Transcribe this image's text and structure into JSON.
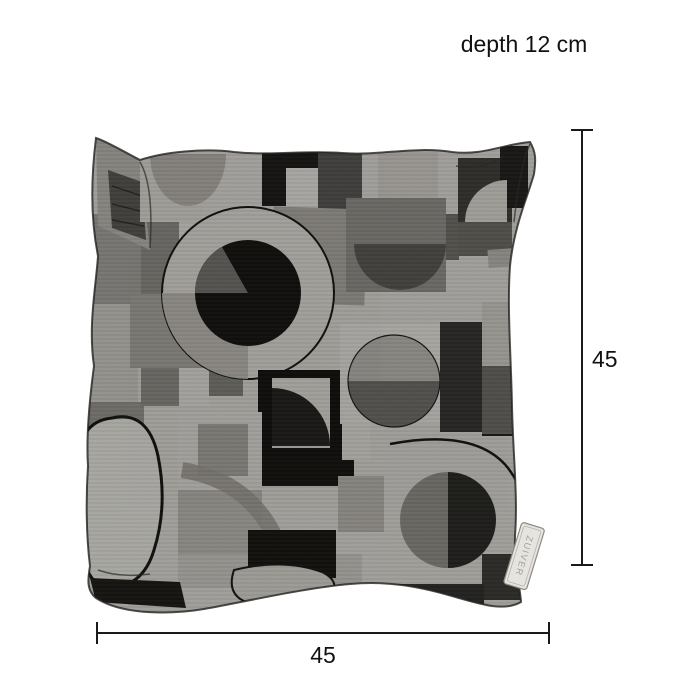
{
  "labels": {
    "depth": "depth 12 cm",
    "height": "45",
    "width": "45"
  },
  "cushion": {
    "brand_tag": "ZUIVER",
    "palette": {
      "near_black": "#141311",
      "dark_gray": "#3e3c38",
      "mid_dark": "#6d6b66",
      "mid_gray": "#8b8983",
      "warm_gray": "#aeaba4",
      "light_gray": "#c7c4bd",
      "pale": "#d8d5ce",
      "lightest": "#e1dfd9"
    }
  },
  "colors": {
    "canvas_background": "#ffffff",
    "dimension_line": "#1a1a1a",
    "label_text": "#111111"
  }
}
